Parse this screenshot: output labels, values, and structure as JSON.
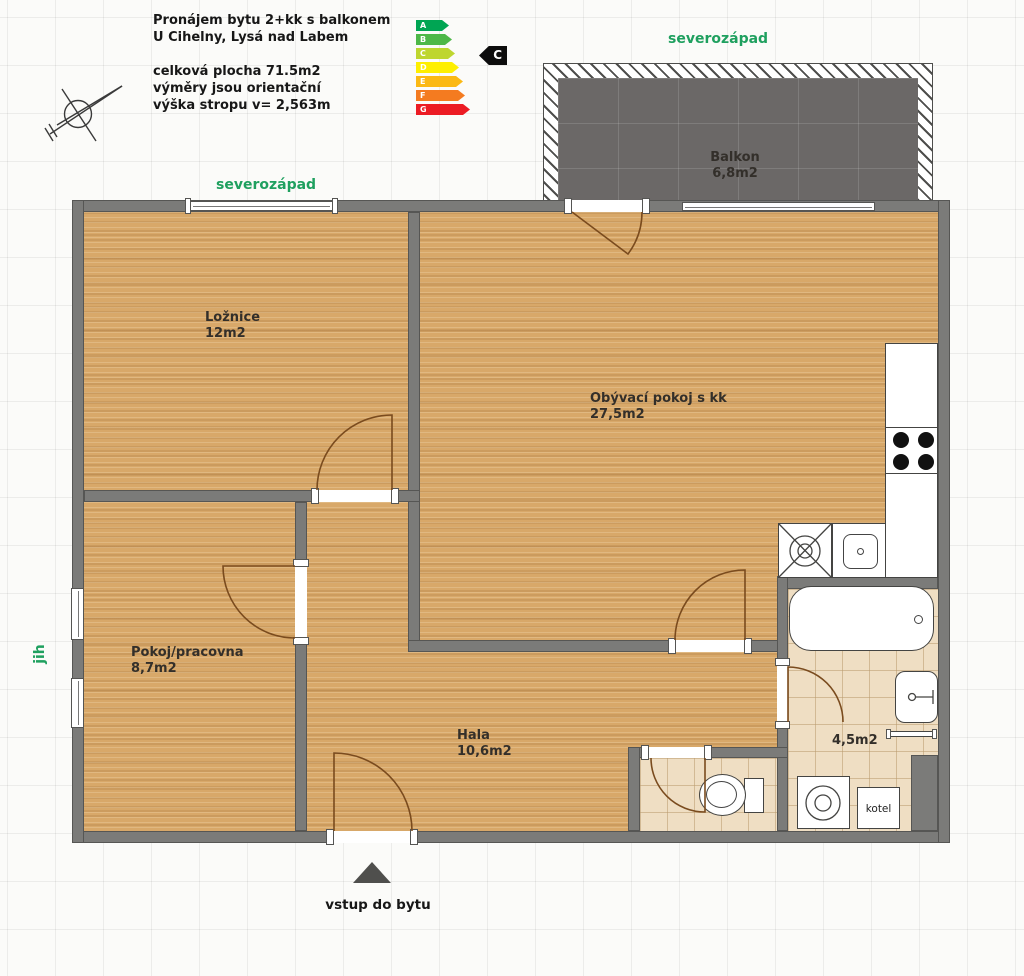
{
  "header": {
    "title_line1": "Pronájem bytu 2+kk s balkonem",
    "title_line2": "U Cihelny, Lysá nad Labem",
    "detail_line1": "celková plocha 71.5m2",
    "detail_line2": "výměry jsou orientační",
    "detail_line3": "výška stropu v= 2,563m"
  },
  "energy_label": {
    "current_class": "C",
    "classes": [
      {
        "letter": "A",
        "color": "#00a553"
      },
      {
        "letter": "B",
        "color": "#4db848"
      },
      {
        "letter": "C",
        "color": "#bed62f"
      },
      {
        "letter": "D",
        "color": "#feef00"
      },
      {
        "letter": "E",
        "color": "#fbb914"
      },
      {
        "letter": "F",
        "color": "#f47b20"
      },
      {
        "letter": "G",
        "color": "#ec1c24"
      }
    ]
  },
  "orientation": {
    "top": "severozápad",
    "plan_top": "severozápad",
    "left": "jih"
  },
  "rooms": {
    "loznice": {
      "name": "Ložnice",
      "area": "12m2"
    },
    "obyvaci": {
      "name": "Obývací pokoj s kk",
      "area": "27,5m2"
    },
    "pokoj": {
      "name": "Pokoj/pracovna",
      "area": "8,7m2"
    },
    "hala": {
      "name": "Hala",
      "area": "10,6m2"
    },
    "koupelna": {
      "area": "4,5m2"
    },
    "balkon": {
      "name": "Balkon",
      "area": "6,8m2"
    }
  },
  "fixtures": {
    "boiler_label": "kotel"
  },
  "entrance": {
    "label": "vstup do bytu"
  }
}
